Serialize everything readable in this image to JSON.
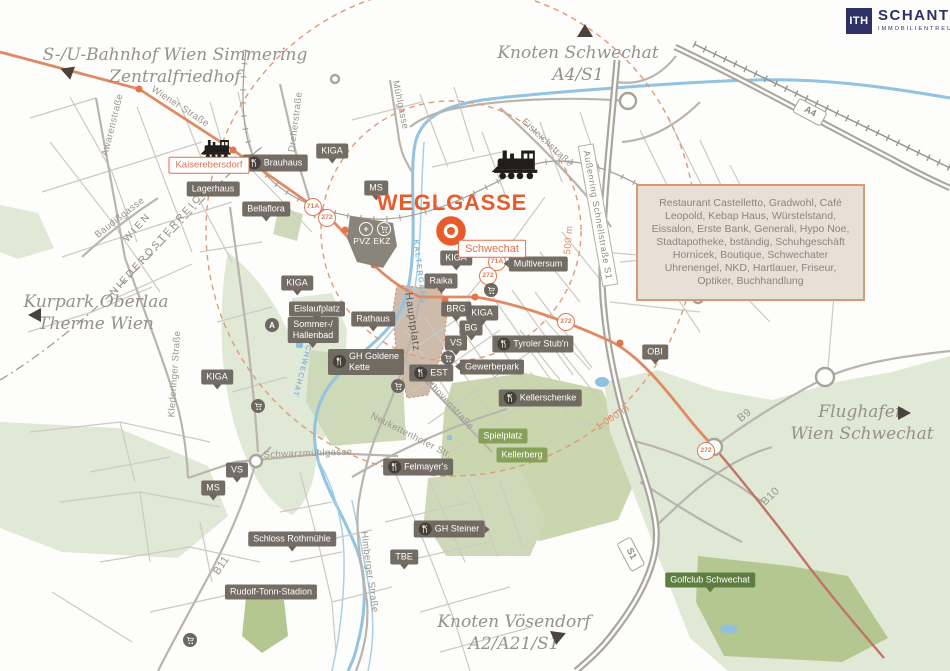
{
  "brand": {
    "logo_text": "ITH",
    "name": "SCHANTL",
    "tagline": "IMMOBILIENTREUHAND"
  },
  "property": {
    "name": "WEGLGASSE"
  },
  "info_box": {
    "text": "Restaurant Castelletto, Gradwohl, Café Leopold, Kebap Haus, Würstelstand, Eissalon, Erste Bank, Generali, Hypo Noe, Stadtapotheke, bständig, Schuhgeschäft Hornicek, Boutique, Schwechater Uhrenengel, NKD, Hartlauer, Friseur, Optiker, Buchhandlung"
  },
  "directions": {
    "simmering": {
      "line1": "S-/U-Bahnhof Wien Simmering",
      "line2": "Zentralfriedhof"
    },
    "knoten_schwechat": {
      "line1": "Knoten Schwechat",
      "line2": "A4/S1"
    },
    "kurpark": {
      "line1": "Kurpark Oberlaa",
      "line2": "Therme Wien"
    },
    "flughafen": {
      "line1": "Flughafen",
      "line2": "Wien Schwechat"
    },
    "voesendorf": {
      "line1": "Knoten Vösendorf",
      "line2": "A2/A21/S1"
    }
  },
  "radius_rings": [
    {
      "label": "500 m",
      "radius_m": 500
    },
    {
      "label": "1.000 m",
      "radius_m": 1000
    }
  ],
  "colors": {
    "accent_orange": "#e85c2c",
    "brand_navy": "#2f3166",
    "label_dark": "#6c655d",
    "label_green": "#87a159",
    "label_green_dark": "#5e7d41",
    "route_orange": "#e08a63",
    "river_blue": "#92c3e0",
    "park_green": "#e0e8d6",
    "info_box_bg": "#e8e0d6",
    "info_box_border": "#d89a76",
    "street_gray": "#9b958c"
  },
  "map_labels": [
    {
      "id": "brauhaus",
      "text": "Brauhaus",
      "type": "dark",
      "x": 275,
      "y": 163,
      "icon": "food"
    },
    {
      "id": "lagerhaus",
      "text": "Lagerhaus",
      "type": "dark",
      "x": 213,
      "y": 189
    },
    {
      "id": "bellaflora",
      "text": "Bellaflora",
      "type": "dark",
      "x": 266,
      "y": 209,
      "tail": "down"
    },
    {
      "id": "kiga-1",
      "text": "KIGA",
      "type": "dark",
      "x": 332,
      "y": 151,
      "tail": "down"
    },
    {
      "id": "ms-1",
      "text": "MS",
      "type": "dark",
      "x": 376,
      "y": 188,
      "tail": "down"
    },
    {
      "id": "kiga-2",
      "text": "KIGA",
      "type": "dark",
      "x": 297,
      "y": 283,
      "tail": "down"
    },
    {
      "id": "eislaufplatz",
      "text": "Eislaufplatz",
      "type": "dark",
      "x": 317,
      "y": 309,
      "tail": "down"
    },
    {
      "id": "sommer-hallenbad",
      "text": "Sommer-/\nHallenbad",
      "type": "dark",
      "x": 313,
      "y": 330,
      "tail": "down"
    },
    {
      "id": "rathaus",
      "text": "Rathaus",
      "type": "dark",
      "x": 373,
      "y": 319,
      "tail": "down"
    },
    {
      "id": "gh-goldene-kette",
      "text": "GH Goldene\nKette",
      "type": "dark",
      "x": 366,
      "y": 362,
      "icon": "food"
    },
    {
      "id": "est",
      "text": "EST",
      "type": "dark",
      "x": 431,
      "y": 373,
      "icon": "food"
    },
    {
      "id": "kiga-3",
      "text": "KIGA",
      "type": "dark",
      "x": 217,
      "y": 377,
      "tail": "down"
    },
    {
      "id": "raika",
      "text": "Raika",
      "type": "dark",
      "x": 441,
      "y": 281,
      "tail": "down"
    },
    {
      "id": "brg",
      "text": "BRG",
      "type": "dark",
      "x": 456,
      "y": 309,
      "tail": "down"
    },
    {
      "id": "kiga-4",
      "text": "KIGA",
      "type": "dark",
      "x": 482,
      "y": 313,
      "tail": "down"
    },
    {
      "id": "kiga-5",
      "text": "KIGA",
      "type": "dark",
      "x": 456,
      "y": 258,
      "tail": "down"
    },
    {
      "id": "bg",
      "text": "BG",
      "type": "dark",
      "x": 471,
      "y": 328,
      "tail": "down"
    },
    {
      "id": "vs-1",
      "text": "VS",
      "type": "dark",
      "x": 456,
      "y": 343,
      "tail": "down"
    },
    {
      "id": "multiversum",
      "text": "Multiversum",
      "type": "dark",
      "x": 538,
      "y": 264,
      "tail": "left"
    },
    {
      "id": "gewerbepark",
      "text": "Gewerbepark",
      "type": "dark",
      "x": 492,
      "y": 367,
      "tail": "left"
    },
    {
      "id": "tyroler-stubn",
      "text": "Tyroler Stub'n",
      "type": "dark",
      "x": 533,
      "y": 344,
      "icon": "food"
    },
    {
      "id": "kellerschenke",
      "text": "Kellerschenke",
      "type": "dark",
      "x": 540,
      "y": 398,
      "icon": "food"
    },
    {
      "id": "felmayers",
      "text": "Felmayer's",
      "type": "dark",
      "x": 418,
      "y": 467,
      "icon": "food"
    },
    {
      "id": "gh-steiner",
      "text": "GH Steiner",
      "type": "dark",
      "x": 449,
      "y": 529,
      "icon": "food",
      "tail": "right"
    },
    {
      "id": "tbe",
      "text": "TBE",
      "type": "dark",
      "x": 404,
      "y": 557,
      "tail": "down"
    },
    {
      "id": "schloss-rothmuehle",
      "text": "Schloss Rothmühle",
      "type": "dark",
      "x": 292,
      "y": 539,
      "tail": "down"
    },
    {
      "id": "rudolf-tonn-stadion",
      "text": "Rudolf-Tonn-Stadion",
      "type": "dark",
      "x": 271,
      "y": 592
    },
    {
      "id": "obi",
      "text": "OBI",
      "type": "dark",
      "x": 655,
      "y": 352,
      "tail": "down"
    },
    {
      "id": "vs-2",
      "text": "VS",
      "type": "dark",
      "x": 237,
      "y": 470,
      "tail": "down"
    },
    {
      "id": "ms-2",
      "text": "MS",
      "type": "dark",
      "x": 213,
      "y": 488,
      "tail": "down"
    },
    {
      "id": "pvz-ekz",
      "text": "PVZ EKZ",
      "type": "plain-white",
      "x": 372,
      "y": 241
    },
    {
      "id": "kaiserebersdorf",
      "text": "Kaiserebersdorf",
      "type": "orange",
      "x": 209,
      "y": 165
    },
    {
      "id": "schwechat",
      "text": "Schwechat",
      "type": "orange",
      "x": 492,
      "y": 249,
      "fs": 11
    },
    {
      "id": "spielplatz",
      "text": "Spielplatz",
      "type": "green",
      "x": 503,
      "y": 436
    },
    {
      "id": "kellerberg",
      "text": "Kellerberg",
      "type": "green",
      "x": 522,
      "y": 455
    },
    {
      "id": "golfclub-schwechat",
      "text": "Golfclub Schwechat",
      "type": "green-dark",
      "x": 710,
      "y": 580,
      "tail": "down"
    },
    {
      "id": "wiener-strasse",
      "text": "Wiener Straße",
      "type": "street",
      "x": 180,
      "y": 107,
      "rot": 33
    },
    {
      "id": "awarenstrasse",
      "text": "Awarenstraße",
      "type": "street",
      "x": 113,
      "y": 125,
      "rot": -76
    },
    {
      "id": "baudissgasse",
      "text": "Baudißgasse",
      "type": "street",
      "x": 120,
      "y": 218,
      "rot": -38
    },
    {
      "id": "dreherstrasse",
      "text": "Dreherstraße",
      "type": "street",
      "x": 296,
      "y": 122,
      "rot": -83
    },
    {
      "id": "wien-caps",
      "text": "WIEN",
      "type": "street-caps",
      "x": 138,
      "y": 228,
      "rot": -48
    },
    {
      "id": "niederoesterreich-caps",
      "text": "NIEDERÖSTERREICH",
      "type": "street-caps",
      "x": 160,
      "y": 242,
      "rot": -48
    },
    {
      "id": "muehlgasse",
      "text": "Mühlgasse",
      "type": "street",
      "x": 400,
      "y": 105,
      "rot": 78
    },
    {
      "id": "eisteichstrasse",
      "text": "Eisteichstraße",
      "type": "street",
      "x": 547,
      "y": 143,
      "rot": 43
    },
    {
      "id": "aussenring",
      "text": "Außenring Schnellstraße S1",
      "type": "white-box",
      "x": 598,
      "y": 215,
      "rot": 80
    },
    {
      "id": "klederinger-strasse",
      "text": "Klederinger Straße",
      "type": "street",
      "x": 175,
      "y": 374,
      "rot": -86
    },
    {
      "id": "schwarzmuehlgasse",
      "text": "Schwarzmühlgasse",
      "type": "street",
      "x": 308,
      "y": 454,
      "rot": -2
    },
    {
      "id": "neukettenhofer-str",
      "text": "Neukettenhofer Str.",
      "type": "street",
      "x": 411,
      "y": 436,
      "rot": 27
    },
    {
      "id": "beethovenstrasse",
      "text": "Beethovenstraße",
      "type": "street",
      "x": 445,
      "y": 400,
      "rot": 47
    },
    {
      "id": "himberger-strasse",
      "text": "Himberger Straße",
      "type": "street",
      "x": 369,
      "y": 572,
      "rot": 82
    },
    {
      "id": "b11",
      "text": "B11",
      "type": "street",
      "x": 222,
      "y": 566,
      "rot": -56,
      "fs": 11
    },
    {
      "id": "b9",
      "text": "B9",
      "type": "street",
      "x": 745,
      "y": 416,
      "rot": -38,
      "fs": 11
    },
    {
      "id": "b10",
      "text": "B10",
      "type": "street",
      "x": 771,
      "y": 497,
      "rot": -44,
      "fs": 11
    },
    {
      "id": "hauptplatz",
      "text": "Hauptplatz",
      "type": "plain-dark",
      "x": 412,
      "y": 322,
      "rot": 82
    },
    {
      "id": "kaltergang",
      "text": "KALTERGANG",
      "type": "blue",
      "x": 420,
      "y": 272,
      "rot": 83
    },
    {
      "id": "schwechat-fluss",
      "text": "SCHWECHAT",
      "type": "blue",
      "x": 303,
      "y": 368,
      "rot": 105
    },
    {
      "id": "ring-500m",
      "text": "500 m",
      "type": "radius",
      "x": 569,
      "y": 240,
      "rot": -85
    },
    {
      "id": "ring-1000m",
      "text": "1.000 m",
      "type": "radius",
      "x": 613,
      "y": 418,
      "rot": -33
    },
    {
      "id": "71a-1",
      "text": "71A",
      "type": "badge-circle",
      "x": 313,
      "y": 207
    },
    {
      "id": "272-1",
      "text": "272",
      "type": "badge-circle",
      "x": 327,
      "y": 218
    },
    {
      "id": "71a-2",
      "text": "71A",
      "type": "badge-circle",
      "x": 497,
      "y": 262
    },
    {
      "id": "272-2",
      "text": "272",
      "type": "badge-circle",
      "x": 488,
      "y": 276
    },
    {
      "id": "272-3",
      "text": "272",
      "type": "badge-circle",
      "x": 566,
      "y": 322
    },
    {
      "id": "272-4",
      "text": "272",
      "type": "badge-circle",
      "x": 706,
      "y": 451
    },
    {
      "id": "a4",
      "text": "A4",
      "type": "badge-rect",
      "x": 810,
      "y": 112,
      "rot": 28
    },
    {
      "id": "s1",
      "text": "S1",
      "type": "badge-rect",
      "x": 631,
      "y": 554,
      "rot": 62
    }
  ],
  "poi_icons": [
    {
      "id": "pvz-plus",
      "kind": "plus-white",
      "glyph": "+",
      "x": 366,
      "y": 229
    },
    {
      "id": "pvz-cart",
      "kind": "cart-white",
      "x": 384,
      "y": 229
    },
    {
      "id": "poi-a",
      "kind": "letter",
      "glyph": "A",
      "x": 272,
      "y": 325
    },
    {
      "id": "cart-1",
      "kind": "cart",
      "x": 491,
      "y": 290
    },
    {
      "id": "cart-2",
      "kind": "cart",
      "x": 398,
      "y": 386
    },
    {
      "id": "cart-3",
      "kind": "cart",
      "x": 258,
      "y": 406
    },
    {
      "id": "cart-4",
      "kind": "cart",
      "x": 190,
      "y": 640
    },
    {
      "id": "cart-5",
      "kind": "cart",
      "x": 448,
      "y": 358
    }
  ]
}
